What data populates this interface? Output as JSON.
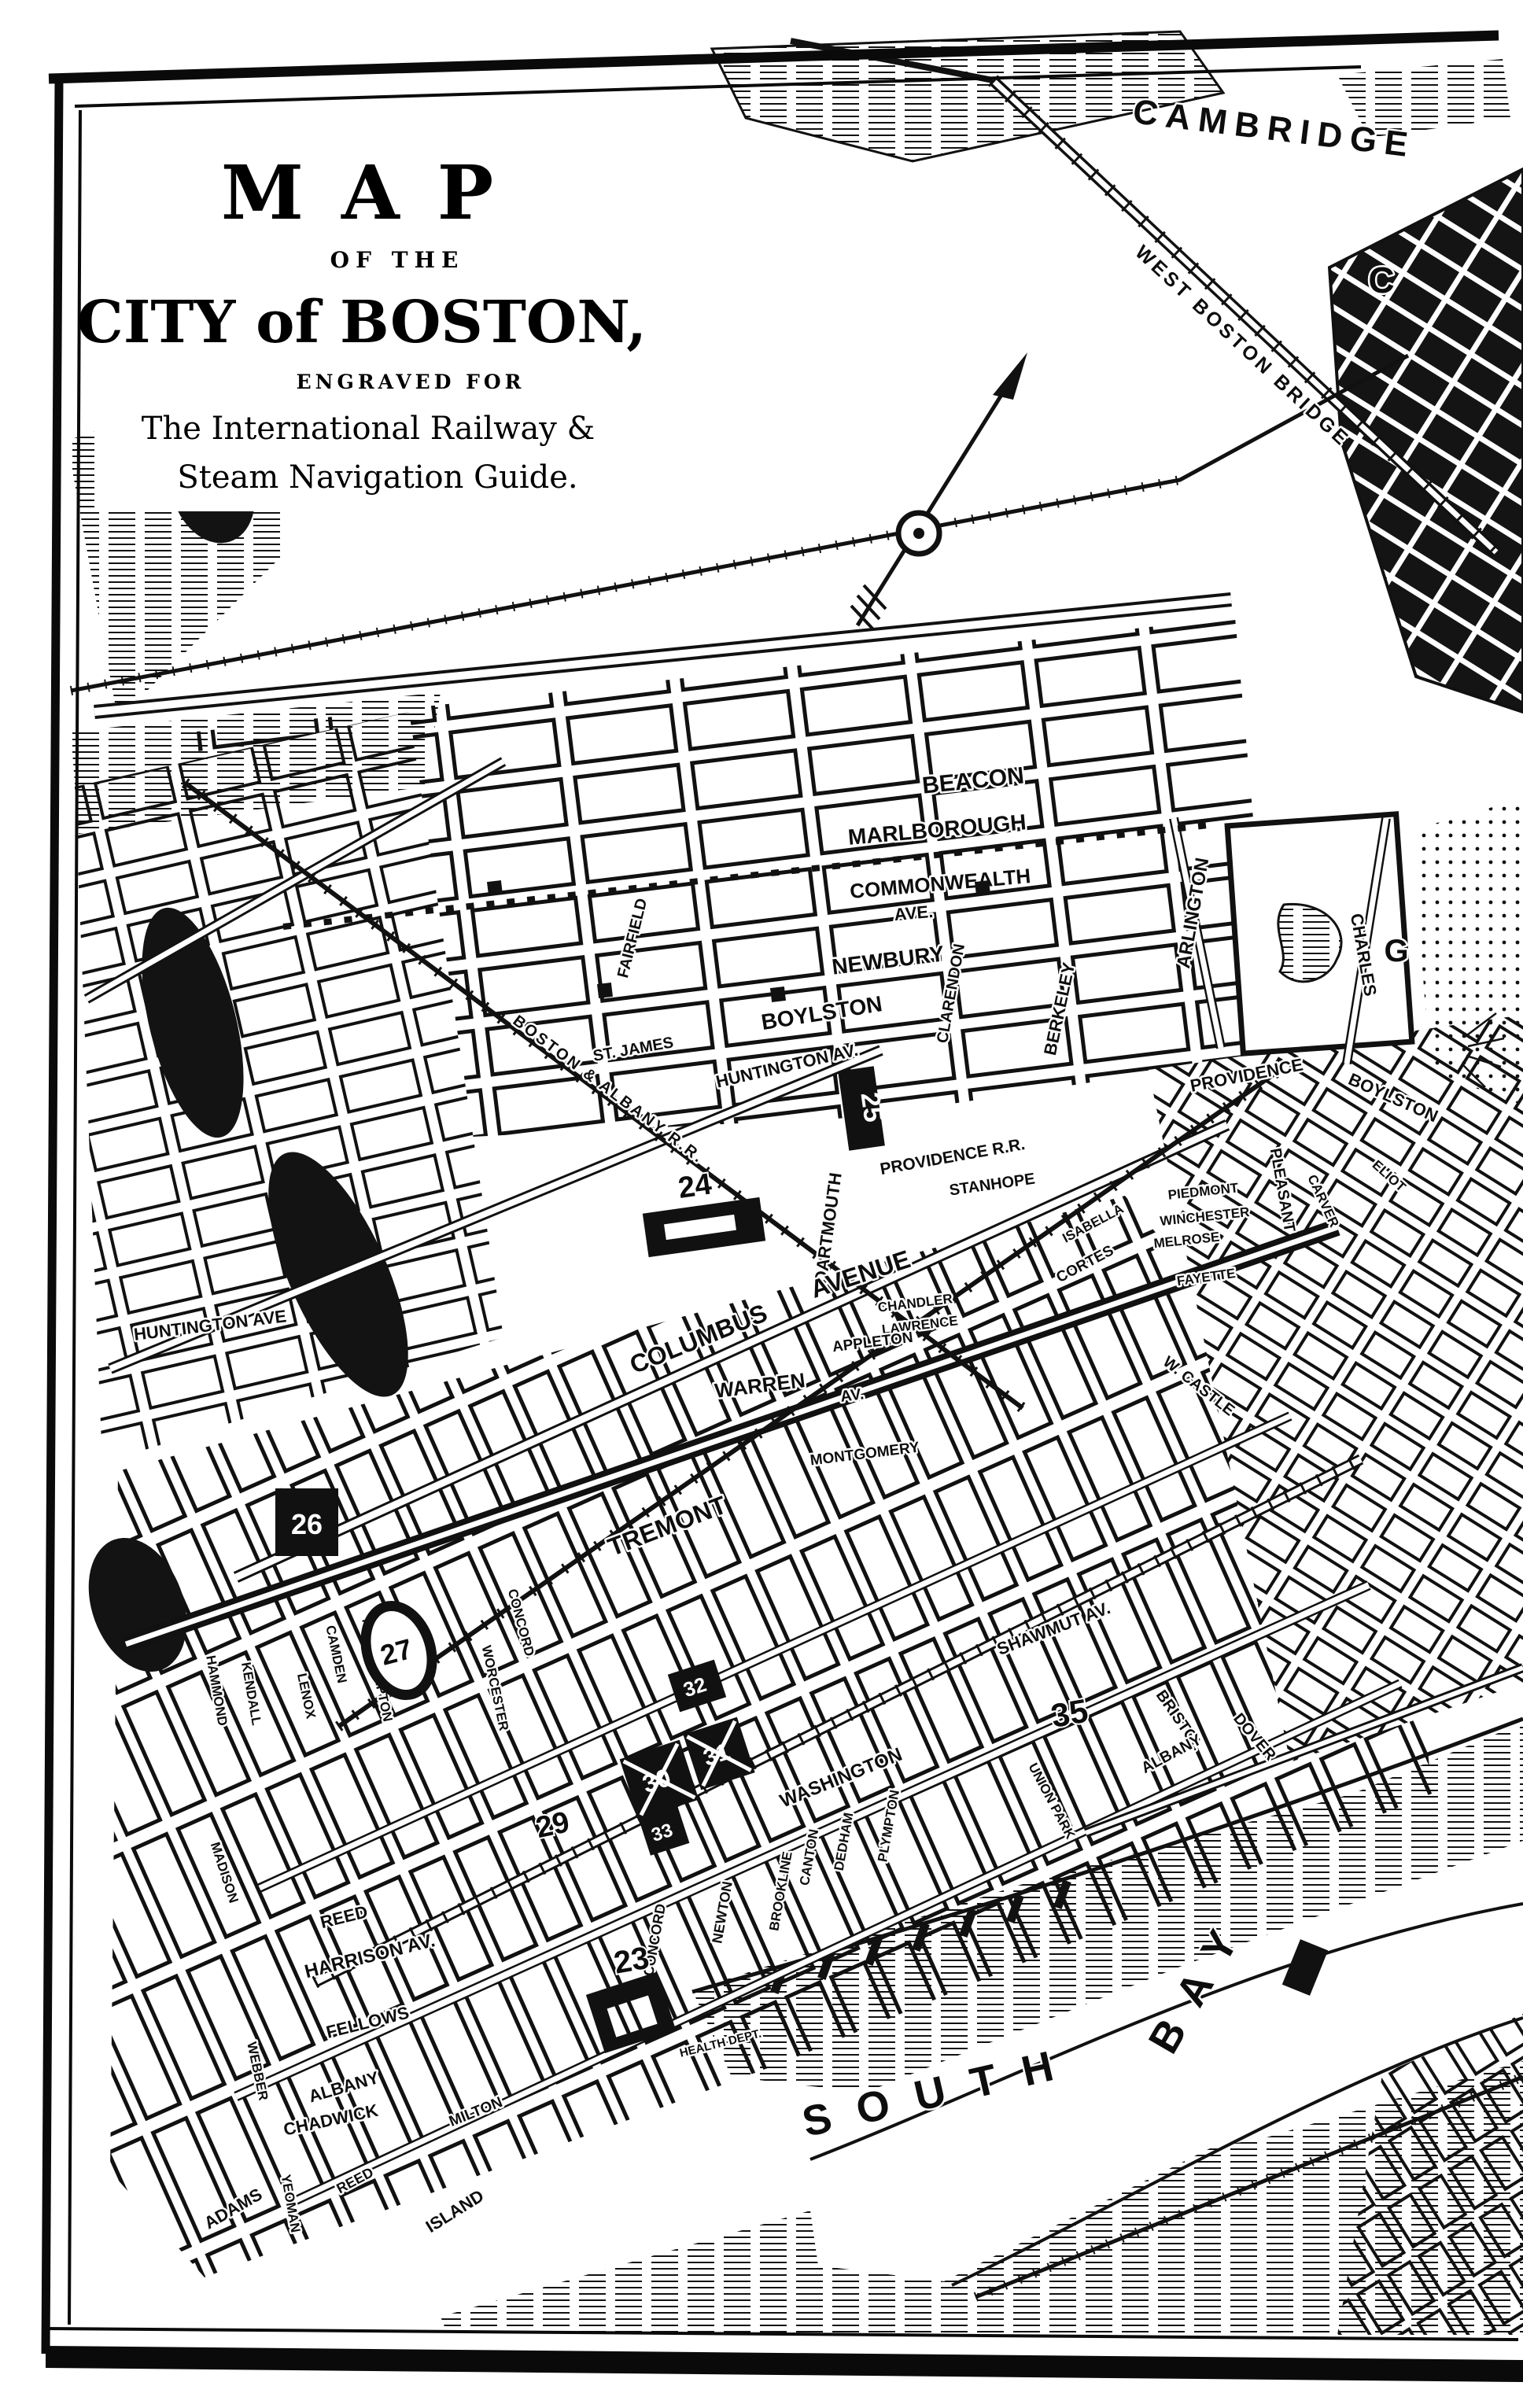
{
  "page": {
    "paper": "#ffffff",
    "ink": "#111111"
  },
  "title_block": {
    "line1": "MAP",
    "line2": "OF THE",
    "line3": "CITY of BOSTON,",
    "line4": "ENGRAVED FOR",
    "line5": "The International Railway &",
    "line6": "Steam Navigation Guide."
  },
  "regions": {
    "cambridge": "CAMBRIDGE",
    "west_boston_bridge": "WEST BOSTON BRIDGE",
    "letter_c": "C",
    "letter_g": "G",
    "south": "SOUTH",
    "bay": "BAY"
  },
  "streets": {
    "beacon": "BEACON",
    "marlborough": "MARLBOROUGH",
    "commonwealth": "COMMONWEALTH",
    "commonwealth_ave": "AVE.",
    "newbury": "NEWBURY",
    "boylston": "BOYLSTON",
    "st_james": "ST. JAMES",
    "huntington_av": "HUNTINGTON AV.",
    "huntington_ave": "HUNTINGTON AVE",
    "stanhope": "STANHOPE",
    "providence": "PROVIDENCE",
    "boylston2": "BOYLSTON",
    "arlington": "ARLINGTON",
    "berkeley": "BERKELEY",
    "clarendon": "CLARENDON",
    "dartmouth": "DARTMOUTH",
    "fairfield": "FAIRFIELD",
    "charles": "CHARLES",
    "columbus": "COLUMBUS",
    "columbus_avenue": "AVENUE",
    "warren": "WARREN",
    "warren_av": "AV.",
    "chandler": "CHANDLER",
    "lawrence": "LAWRENCE",
    "appleton": "APPLETON",
    "montgomery": "MONTGOMERY",
    "tremont": "TREMONT",
    "shawmut": "SHAWMUT AV.",
    "washington": "WASHINGTON",
    "james": "JAMES",
    "concord_v": "CONCORD",
    "newton": "NEWTON",
    "brookline": "BROOKLINE",
    "canton": "CANTON",
    "dedham": "DEDHAM",
    "plympton": "PLYMPTON",
    "harrison": "HARRISON AV.",
    "reed": "REED",
    "fellows": "FELLOWS",
    "albany": "ALBANY",
    "chadwick": "CHADWICK",
    "adams": "ADAMS",
    "yeoman": "YEOMAN",
    "reed2": "REED",
    "island": "ISLAND",
    "milton": "MILTON",
    "webber": "WEBBER",
    "madison": "MADISON",
    "hammond": "HAMMOND",
    "kendall": "KENDALL",
    "lenox": "LENOX",
    "camden": "CAMDEN",
    "northampton": "NORTHAMPTON",
    "worcester": "WORCESTER",
    "concord2": "CONCORD",
    "union_park": "UNION PARK",
    "bristol": "BRISTOL",
    "dover": "DOVER",
    "albany2": "ALBANY",
    "piedmont": "PIEDMONT",
    "winchester": "WINCHESTER",
    "melrose": "MELROSE",
    "isabella": "ISABELLA",
    "cortes": "CORTES",
    "fayette": "FAYETTE",
    "pleasant": "PLEASANT",
    "w_castle": "W. CASTLE",
    "eliot": "ELIOT",
    "carver": "CARVER"
  },
  "railroads": {
    "boston_albany": "BOSTON & ALBANY R.R.",
    "providence_rr": "PROVIDENCE R.R."
  },
  "landmarks": {
    "n23": "23",
    "n24": "24",
    "n25": "25",
    "n26": "26",
    "n27": "27",
    "n29": "29",
    "n30": "30",
    "n31": "31",
    "n32": "32",
    "n33": "33",
    "n35": "35"
  },
  "notes": {
    "health_dept": "HEALTH DEPT."
  }
}
